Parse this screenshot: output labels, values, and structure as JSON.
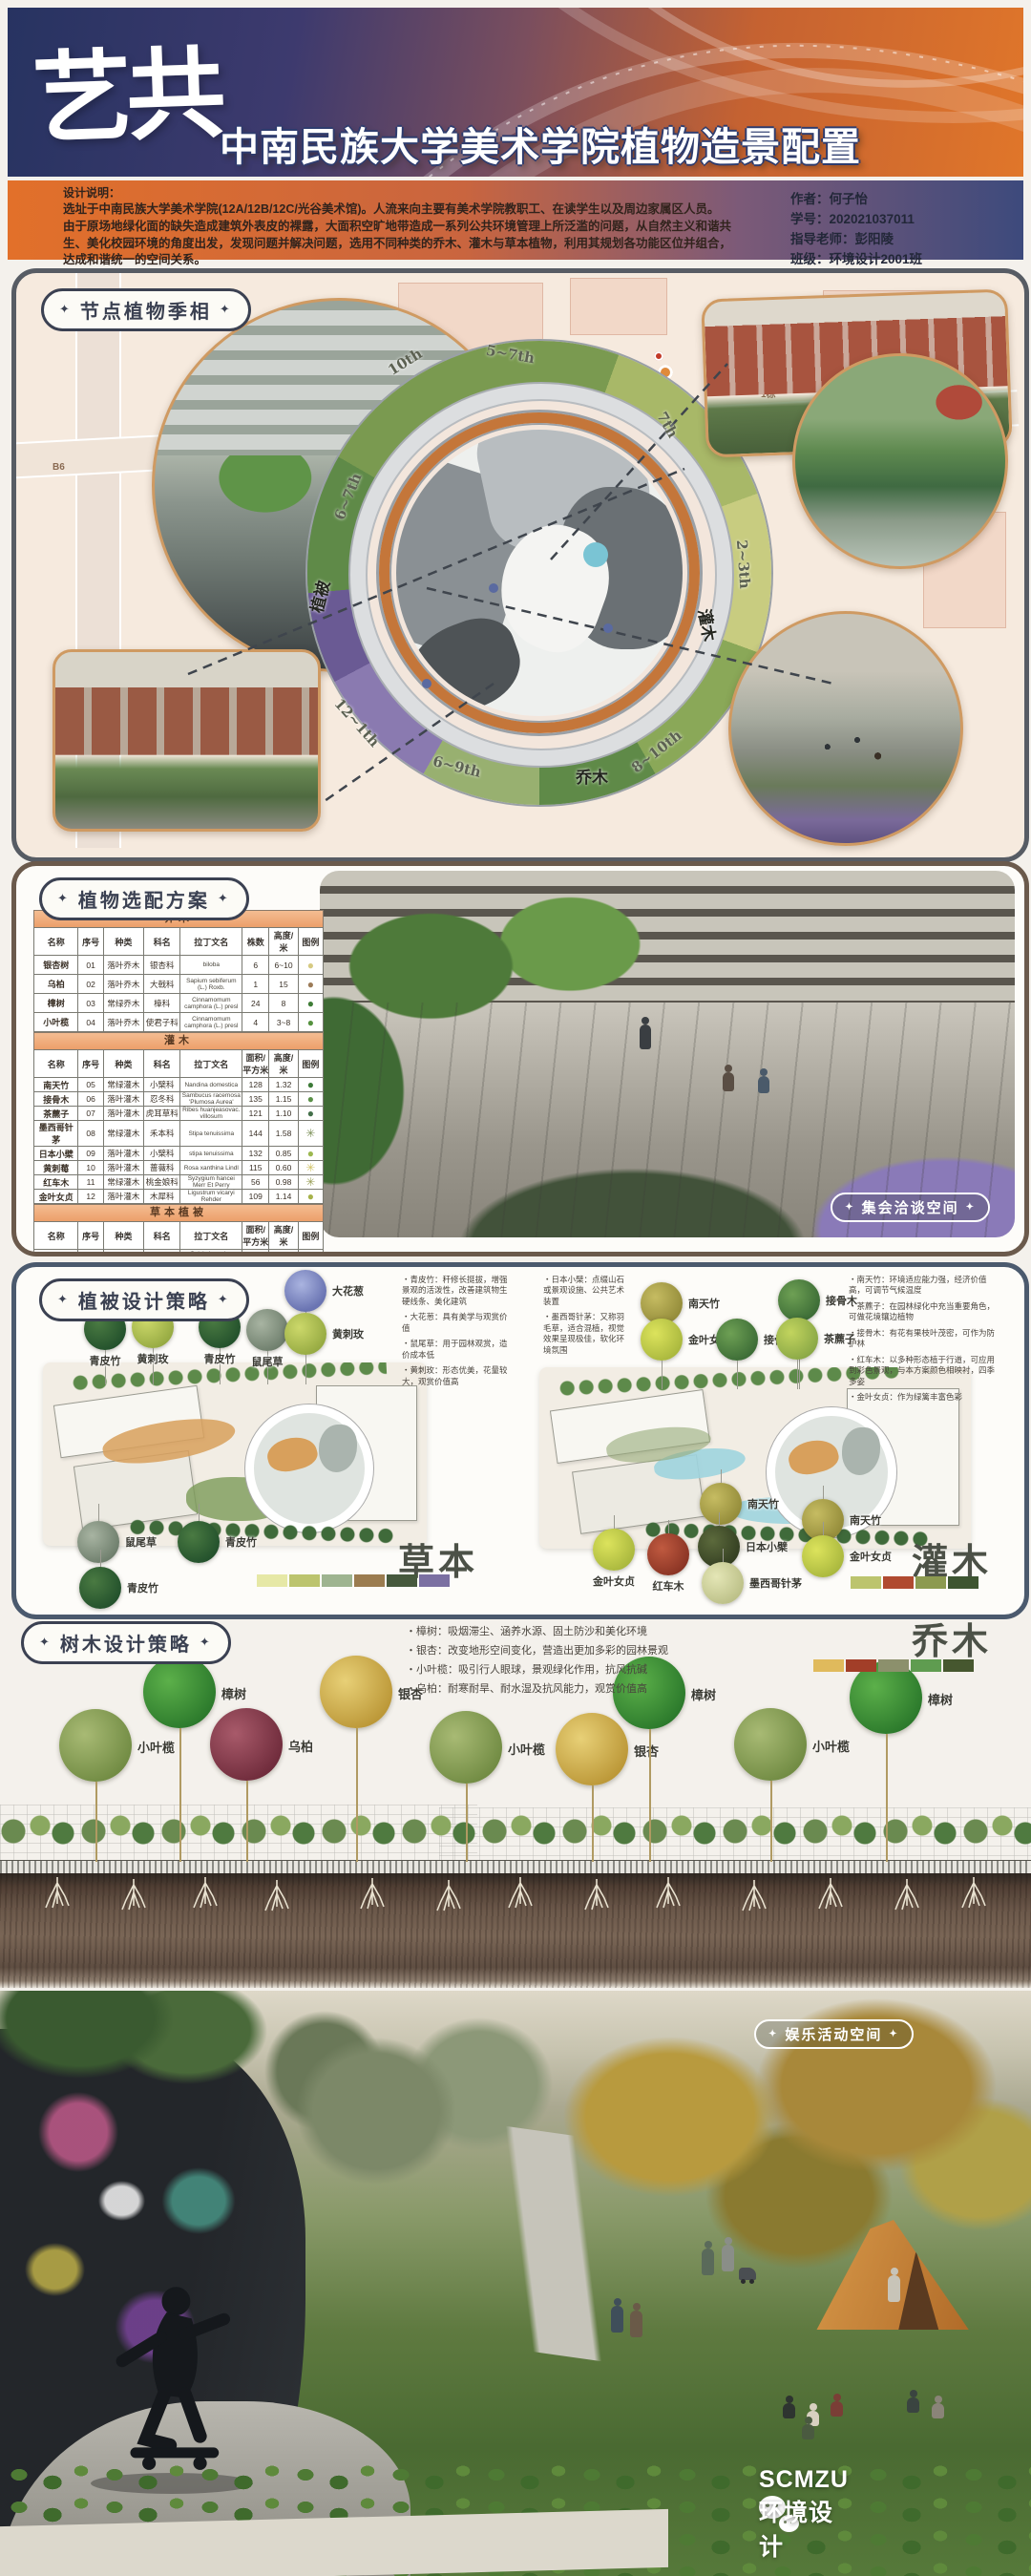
{
  "header": {
    "logo": "艺共",
    "title": "中南民族大学美术学院植物造景配置"
  },
  "info": {
    "label": "设计说明：",
    "description": "选址于中南民族大学美术学院(12A/12B/12C/光谷美术馆)。人流来向主要有美术学院教职工、在读学生以及周边家属区人员。由于原场地绿化面的缺失造成建筑外表皮的裸露，大面积空旷地带造成一系列公共环境管理上所泛滥的问题，从自然主义和谐共生、美化校园环境的角度出发，发现问题并解决问题，选用不同种类的乔木、灌木与草本植物，利用其规划各功能区位并组合，达成和谐统一的空间关系。",
    "author": "作者：何子怡",
    "student_id": "学号：202021037011",
    "advisor": "指导老师：彭阳陵",
    "class": "班级：环境设计2001班"
  },
  "season_section": {
    "title": "节点植物季相",
    "ring_labels": [
      "10th",
      "5~7th",
      "7th",
      "2~3th",
      "6~7th",
      "8~10th",
      "6~9th",
      "12~1th"
    ],
    "zones": {
      "trees": "乔木",
      "shrubs": "灌木",
      "vegetation": "植被"
    },
    "map_labels": {
      "courier": "德邦快递",
      "building": "1栋",
      "b6": "B6"
    }
  },
  "plant_table_section": {
    "title": "植物选配方案",
    "badge": "集会洽谈空间",
    "groups": [
      {
        "band": "乔木",
        "headers": [
          "名称",
          "序号",
          "种类",
          "科名",
          "拉丁文名",
          "株数",
          "高度/米",
          "图例"
        ],
        "rows": [
          [
            "银杏树",
            "01",
            "落叶乔木",
            "银杏科",
            "biloba",
            "6",
            "6~10",
            {
              "glyph": "●",
              "color": "#d6ca82"
            }
          ],
          [
            "乌柏",
            "02",
            "落叶乔木",
            "大戟科",
            "Sapium sebiferum (L.) Roxb.",
            "1",
            "15",
            {
              "glyph": "●",
              "color": "#9c7b58"
            }
          ],
          [
            "樟树",
            "03",
            "常绿乔木",
            "樟科",
            "Cinnamomum camphora (L.) presl",
            "24",
            "8",
            {
              "glyph": "●",
              "color": "#3f7d37"
            }
          ],
          [
            "小叶榄",
            "04",
            "落叶乔木",
            "使君子科",
            "Cinnamomum camphora (L.) presl",
            "4",
            "3~8",
            {
              "glyph": "●",
              "color": "#55923f"
            }
          ]
        ]
      },
      {
        "band": "灌木",
        "headers": [
          "名称",
          "序号",
          "种类",
          "科名",
          "拉丁文名",
          "面积/平方米",
          "高度/米",
          "图例"
        ],
        "rows": [
          [
            "南天竹",
            "05",
            "常绿灌木",
            "小檗科",
            "Nandina domestica",
            "128",
            "1.32",
            {
              "glyph": "●",
              "color": "#3c7a38"
            }
          ],
          [
            "接骨木",
            "06",
            "落叶灌木",
            "忍冬科",
            "Sambucus racemosa 'Plumosa Aurea'",
            "135",
            "1.15",
            {
              "glyph": "●",
              "color": "#5b9048"
            }
          ],
          [
            "茶藨子",
            "07",
            "落叶灌木",
            "虎耳草科",
            "Ribes huanjeasovac. villosum",
            "121",
            "1.10",
            {
              "glyph": "●",
              "color": "#44704a"
            }
          ],
          [
            "墨西哥针茅",
            "08",
            "常绿灌木",
            "禾本科",
            "Stipa tenuissima",
            "144",
            "1.58",
            {
              "glyph": "✳",
              "color": "#7c9058"
            }
          ],
          [
            "日本小檗",
            "09",
            "落叶灌木",
            "小檗科",
            "stipa tenuissima",
            "132",
            "0.85",
            {
              "glyph": "●",
              "color": "#9cb850"
            }
          ],
          [
            "黄刺莓",
            "10",
            "落叶灌木",
            "蔷薇科",
            "Rosa xanthina Lindl",
            "115",
            "0.60",
            {
              "glyph": "✳",
              "color": "#d2c468"
            }
          ],
          [
            "红车木",
            "11",
            "常绿灌木",
            "桃金娘科",
            "Syzygium hancei Merr Et Perry",
            "56",
            "0.98",
            {
              "glyph": "✳",
              "color": "#9aa058"
            }
          ],
          [
            "金叶女贞",
            "12",
            "落叶灌木",
            "木犀科",
            "Ligustrum vicaryi Rehder",
            "109",
            "1.14",
            {
              "glyph": "●",
              "color": "#a6b24a"
            }
          ]
        ]
      },
      {
        "band": "草本植被",
        "headers": [
          "名称",
          "序号",
          "种类",
          "科名",
          "拉丁文名",
          "面积/平方米",
          "高度/米",
          "图例"
        ],
        "rows": [
          [
            "鼠尾草",
            "13",
            "常绿草本",
            "唇形科",
            "Salvia japonica Thunb.",
            "50",
            "0.43",
            {
              "glyph": "✳",
              "color": "#9a94bc"
            }
          ],
          [
            "大葱花",
            "14",
            "常绿草本",
            "百合科",
            "Allium giganteum Regel",
            "15",
            "0.35",
            {
              "glyph": "●",
              "color": "#8a7ab2"
            }
          ],
          [
            "青皮竹",
            "15",
            "落叶草本",
            "禾本科",
            "Bambusa textilis McClure",
            "230",
            "9~12",
            {
              "glyph": "❋",
              "color": "#6a8f4e"
            }
          ]
        ]
      }
    ]
  },
  "vegetation_section": {
    "title": "植被设计策略",
    "herb": {
      "big_label": "草本",
      "swatches": [
        "#e6e8a6",
        "#bcc46e",
        "#9eb490",
        "#9b7c50",
        "#46593d",
        "#7b70a2"
      ],
      "top_callouts": [
        "青皮竹",
        "黄刺玫",
        "青皮竹",
        "鼠尾草",
        "大花葱",
        "黄刺玫"
      ],
      "bottom_callouts": [
        "鼠尾草",
        "青皮竹",
        "青皮竹"
      ],
      "notes": [
        "青皮竹：秆修长挺拔，增强景观的活泼性，改善建筑物生硬线条、美化建筑",
        "大花葱：具有美学与观赏价值",
        "鼠尾草：用于园林观赏，造价成本低",
        "黄刺玫：形态优美，花量较大，观赏价值高"
      ]
    },
    "shrub": {
      "big_label": "灌木",
      "swatches": [
        "#bcc46e",
        "#b04a30",
        "#8c9a50",
        "#3d5531"
      ],
      "top_callouts": [
        "南天竹",
        "金叶女贞",
        "接骨木",
        "接骨木",
        "茶藨子"
      ],
      "bottom_callouts": [
        "金叶女贞",
        "红车木",
        "南天竹",
        "日本小檗",
        "墨西哥针茅",
        "南天竹",
        "金叶女贞"
      ],
      "notes_left": [
        "日本小檗：点缀山石或景观设施、公共艺术装置",
        "墨西哥针茅：又称羽毛草，适合混植，视觉效果呈现极佳，软化环境氛围"
      ],
      "notes_right": [
        "南天竹：环境适应能力强，经济价值高，可调节气候温度",
        "茶藨子：在园林绿化中充当重要角色，可做花境镶边植物",
        "接骨木：有花有果枝叶茂密，可作为防护林",
        "红车木：以多种形态植于行道，可应用到彩色景观，与本方案颜色相映衬，四季多姿",
        "金叶女贞：作为绿篱丰富色彩"
      ]
    }
  },
  "tree_section": {
    "title": "树木设计策略",
    "big_label": "乔木",
    "swatches": [
      "#e0ba5c",
      "#a23e28",
      "#8c906c",
      "#5f9c50",
      "#46572f"
    ],
    "notes": [
      "樟树：吸烟滞尘、涵养水源、固土防沙和美化环境",
      "银杏：改变地形空间变化，营造出更加多彩的园林景观",
      "小叶榄：吸引行人眼球，景观绿化作用，抗风抗碱",
      "乌柏：耐寒耐旱、耐水湿及抗风能力，观赏价值高"
    ],
    "trees": [
      "小叶榄",
      "樟树",
      "乌柏",
      "银杏",
      "小叶榄",
      "银杏",
      "樟树",
      "小叶榄",
      "樟树"
    ]
  },
  "bottom": {
    "badge": "娱乐活动空间",
    "watermark": "SCMZU环境设计"
  },
  "colors": {
    "header_navy": "#273361",
    "header_orange": "#e0762a",
    "band_orange": "#ec9f6a",
    "ring_orange": "#c4763a",
    "pill_border": "#3b4152"
  }
}
